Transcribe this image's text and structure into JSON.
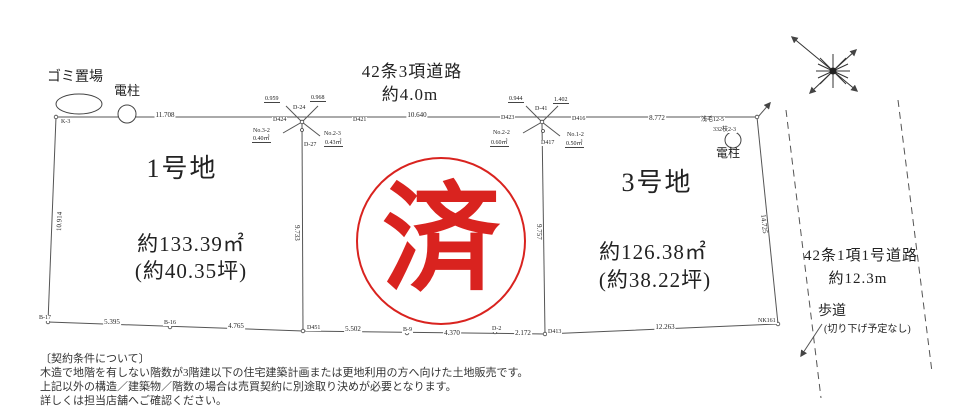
{
  "colors": {
    "stamp_red": "#d9231f",
    "line": "#555555",
    "text": "#222222"
  },
  "landmarks": {
    "garbage": "ゴミ置場",
    "pole_left": "電柱",
    "pole_right": "電柱",
    "pole_right_id1": "浅毛12-5",
    "pole_right_id2": "332枝2-3"
  },
  "roads": {
    "top": {
      "name": "42条3項道路",
      "width": "約4.0m"
    },
    "right": {
      "name": "42条1項1号道路",
      "width": "約12.3m",
      "sidewalk": "歩道",
      "sidewalk_note": "(切り下げ予定なし)"
    }
  },
  "lots": {
    "lot1": {
      "name": "1号地",
      "area_m2": "約133.39㎡",
      "area_tsubo": "(約40.35坪)"
    },
    "lot2": {
      "stamp": "済"
    },
    "lot3": {
      "name": "3号地",
      "area_m2": "約126.38㎡",
      "area_tsubo": "(約38.22坪)"
    }
  },
  "dims": {
    "top_left": "11.708",
    "top_mid": "10.640",
    "top_right": "8.772",
    "left_edge": "10.914",
    "divider1": "9.733",
    "divider2": "9.757",
    "right_edge": "14.725",
    "bottom1": "5.395",
    "bottom2": "4.765",
    "bottom3": "5.502",
    "bottom4": "4.370",
    "bottom5": "2.172",
    "bottom6": "12.263"
  },
  "survey": {
    "c1": {
      "m1": "0.959",
      "m2": "0.968",
      "p1": "D-24",
      "p2": "D424",
      "p3": "D421",
      "n1": "No.3-2",
      "a1": "0.40㎡",
      "n2": "No.2-3",
      "a2": "0.43㎡",
      "p4": "D-27"
    },
    "c2": {
      "m1": "0.944",
      "m2": "1.402",
      "p1": "D-41",
      "p2": "D423",
      "p3": "D416",
      "n1": "No.2-2",
      "a1": "0.60㎡",
      "n2": "No.1-2",
      "a2": "0.50㎡",
      "p4": "D417"
    },
    "corner_tl": "K-3",
    "bp1": "B-17",
    "bp2": "B-16",
    "bp3": "D451",
    "bp4": "B-9",
    "bp5": "D-2",
    "bp6": "D413",
    "bp7": "NK161"
  },
  "notes": {
    "title": "〔契約条件について〕",
    "line1": "木造で地階を有しない階数が3階建以下の住宅建築計画または更地利用の方へ向けた土地販売です。",
    "line2": "上記以外の構造／建築物／階数の場合は売買契約に別途取り決めが必要となります。",
    "line3": "詳しくは担当店舗へご確認ください。"
  }
}
